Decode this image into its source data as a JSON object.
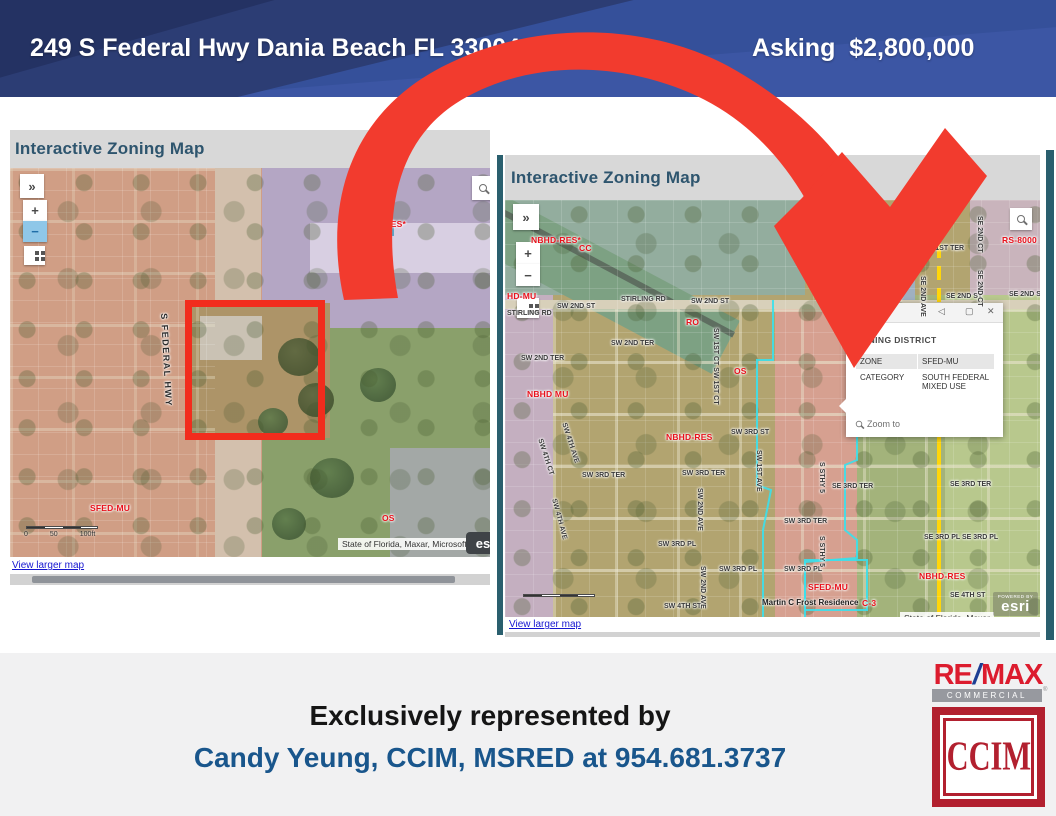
{
  "header": {
    "address": "249 S Federal Hwy Dania Beach FL 33004",
    "asking": "Asking  $2,800,000"
  },
  "left_map": {
    "title": "Interactive Zoning Map",
    "controls": {
      "expand": "»",
      "zoom_in": "+",
      "zoom_out": "−"
    },
    "scale": [
      "0",
      "50",
      "100ft"
    ],
    "attribution": "State of Florida, Maxar, Microsoft",
    "esri_partial": "es",
    "view_larger": "View larger map",
    "labels": [
      {
        "t": "NBHD-RES*",
        "x": 346,
        "y": 52,
        "k": "zone"
      },
      {
        "t": "S FEDERAL HWY",
        "x": 158,
        "y": 145,
        "r": 87,
        "k": "hwy"
      },
      {
        "t": "SFED-MU",
        "x": 80,
        "y": 336,
        "k": "zone"
      },
      {
        "t": "OS",
        "x": 372,
        "y": 346,
        "k": "zone"
      }
    ]
  },
  "right_map": {
    "title": "Interactive Zoning Map",
    "controls": {
      "expand": "»",
      "zoom_in": "+",
      "zoom_out": "−"
    },
    "attribution": "State of Florida, Maxar",
    "esri": {
      "powered": "POWERED BY",
      "brand": "esri"
    },
    "view_larger": "View larger map",
    "popup": {
      "title": "2)",
      "collapse_icon": "◁",
      "maximize_icon": "▢",
      "close_icon": "✕",
      "section": "ZONING DISTRICT",
      "rows": [
        {
          "label": "ZONE",
          "value": "SFED-MU"
        },
        {
          "label": "CATEGORY",
          "value": "SOUTH FEDERAL MIXED USE"
        }
      ],
      "zoom_to": "Zoom to"
    },
    "labels": [
      {
        "t": "NBHD-RES*",
        "x": 26,
        "y": 36,
        "k": "zone"
      },
      {
        "t": "CC",
        "x": 74,
        "y": 44,
        "k": "zone"
      },
      {
        "t": "HD-MU",
        "x": 2,
        "y": 92,
        "k": "zone"
      },
      {
        "t": "RO",
        "x": 181,
        "y": 118,
        "k": "zone"
      },
      {
        "t": "OS",
        "x": 229,
        "y": 167,
        "k": "zone"
      },
      {
        "t": "NBHD MU",
        "x": 22,
        "y": 190,
        "k": "zone"
      },
      {
        "t": "NBHD-RES",
        "x": 161,
        "y": 233,
        "k": "zone"
      },
      {
        "t": "RS-8000",
        "x": 497,
        "y": 36,
        "k": "zone"
      },
      {
        "t": "NBHD-RES",
        "x": 414,
        "y": 372,
        "k": "zone"
      },
      {
        "t": "SFED-MU",
        "x": 303,
        "y": 383,
        "k": "zone"
      },
      {
        "t": "C-3",
        "x": 357,
        "y": 399,
        "k": "zone"
      },
      {
        "t": "STIRLING RD",
        "x": 2,
        "y": 110
      },
      {
        "t": "SW 2ND ST",
        "x": 52,
        "y": 103
      },
      {
        "t": "STIRLING RD",
        "x": 116,
        "y": 96
      },
      {
        "t": "SW 2ND ST",
        "x": 186,
        "y": 98
      },
      {
        "t": "SE 2ND ST",
        "x": 361,
        "y": 96
      },
      {
        "t": "SE 2ND ST",
        "x": 441,
        "y": 93
      },
      {
        "t": "SE 2ND ST",
        "x": 504,
        "y": 91
      },
      {
        "t": "SW 2ND TER",
        "x": 16,
        "y": 155
      },
      {
        "t": "SW 2ND TER",
        "x": 106,
        "y": 140
      },
      {
        "t": "SW 3RD ST",
        "x": 226,
        "y": 229
      },
      {
        "t": "SW 3RD TER",
        "x": 77,
        "y": 272
      },
      {
        "t": "SW 3RD TER",
        "x": 177,
        "y": 270
      },
      {
        "t": "SW 3RD TER",
        "x": 279,
        "y": 318
      },
      {
        "t": "SW 3RD PL",
        "x": 153,
        "y": 341
      },
      {
        "t": "SW 3RD PL",
        "x": 214,
        "y": 366
      },
      {
        "t": "SW 3RD PL",
        "x": 279,
        "y": 366
      },
      {
        "t": "SW 4TH ST",
        "x": 159,
        "y": 403
      },
      {
        "t": "SE 3RD TER",
        "x": 327,
        "y": 283
      },
      {
        "t": "SE 3RD TER",
        "x": 445,
        "y": 281
      },
      {
        "t": "SE 3RD PL SE 3RD PL",
        "x": 419,
        "y": 334
      },
      {
        "t": "SE 4TH ST",
        "x": 445,
        "y": 392
      },
      {
        "t": "SE 1ST TER",
        "x": 419,
        "y": 45
      },
      {
        "t": "1ST TER",
        "x": 367,
        "y": 47
      },
      {
        "t": "SW 1ST CT SW 1ST CT",
        "x": 214,
        "y": 128,
        "r": 90
      },
      {
        "t": "SW 2ND AVE",
        "x": 198,
        "y": 288,
        "r": 90
      },
      {
        "t": "SW 2ND AVE",
        "x": 201,
        "y": 366,
        "r": 90
      },
      {
        "t": "SW 1ST AVE",
        "x": 257,
        "y": 250,
        "r": 90
      },
      {
        "t": "S STHY 5",
        "x": 320,
        "y": 262,
        "r": 90
      },
      {
        "t": "S STHY 5",
        "x": 320,
        "y": 336,
        "r": 90
      },
      {
        "t": "SE 2ND AVE",
        "x": 421,
        "y": 18,
        "r": 90
      },
      {
        "t": "SE 2ND AVE",
        "x": 421,
        "y": 76,
        "r": 90
      },
      {
        "t": "SE 2ND CT",
        "x": 478,
        "y": 16,
        "r": 90
      },
      {
        "t": "SE 2ND CT",
        "x": 478,
        "y": 70,
        "r": 90
      },
      {
        "t": "SW 4TH CT",
        "x": 38,
        "y": 238,
        "r": 72
      },
      {
        "t": "SW 4TH AVE",
        "x": 62,
        "y": 222,
        "r": 72
      },
      {
        "t": "SW 4TH AVE",
        "x": 52,
        "y": 298,
        "r": 75
      },
      {
        "t": "idence",
        "x": 369,
        "y": 74,
        "k": "poi"
      },
      {
        "t": "Martin C Frost Residence",
        "x": 257,
        "y": 399,
        "k": "poi"
      }
    ]
  },
  "footer": {
    "line1": "Exclusively represented by",
    "line2": "Candy Yeung, CCIM, MSRED at 954.681.3737"
  },
  "logos": {
    "remax": {
      "re": "RE",
      "slash": "/",
      "max": "MAX",
      "commercial": "COMMERCIAL",
      "reg": "®"
    },
    "ccim": "CCIM"
  },
  "colors": {
    "header_blue": "#3c56a4",
    "header_navy": "#243263",
    "arrow_red": "#f23b2e",
    "zone_label_red": "#e8111c",
    "footer_blue": "#19568c",
    "remax_red": "#dc1c2e",
    "remax_blue": "#1c3e93",
    "ccim_red": "#b2202f",
    "frame_teal": "#2a5f6e",
    "link_blue": "#1515d0",
    "map_title_teal": "#2e556e"
  }
}
